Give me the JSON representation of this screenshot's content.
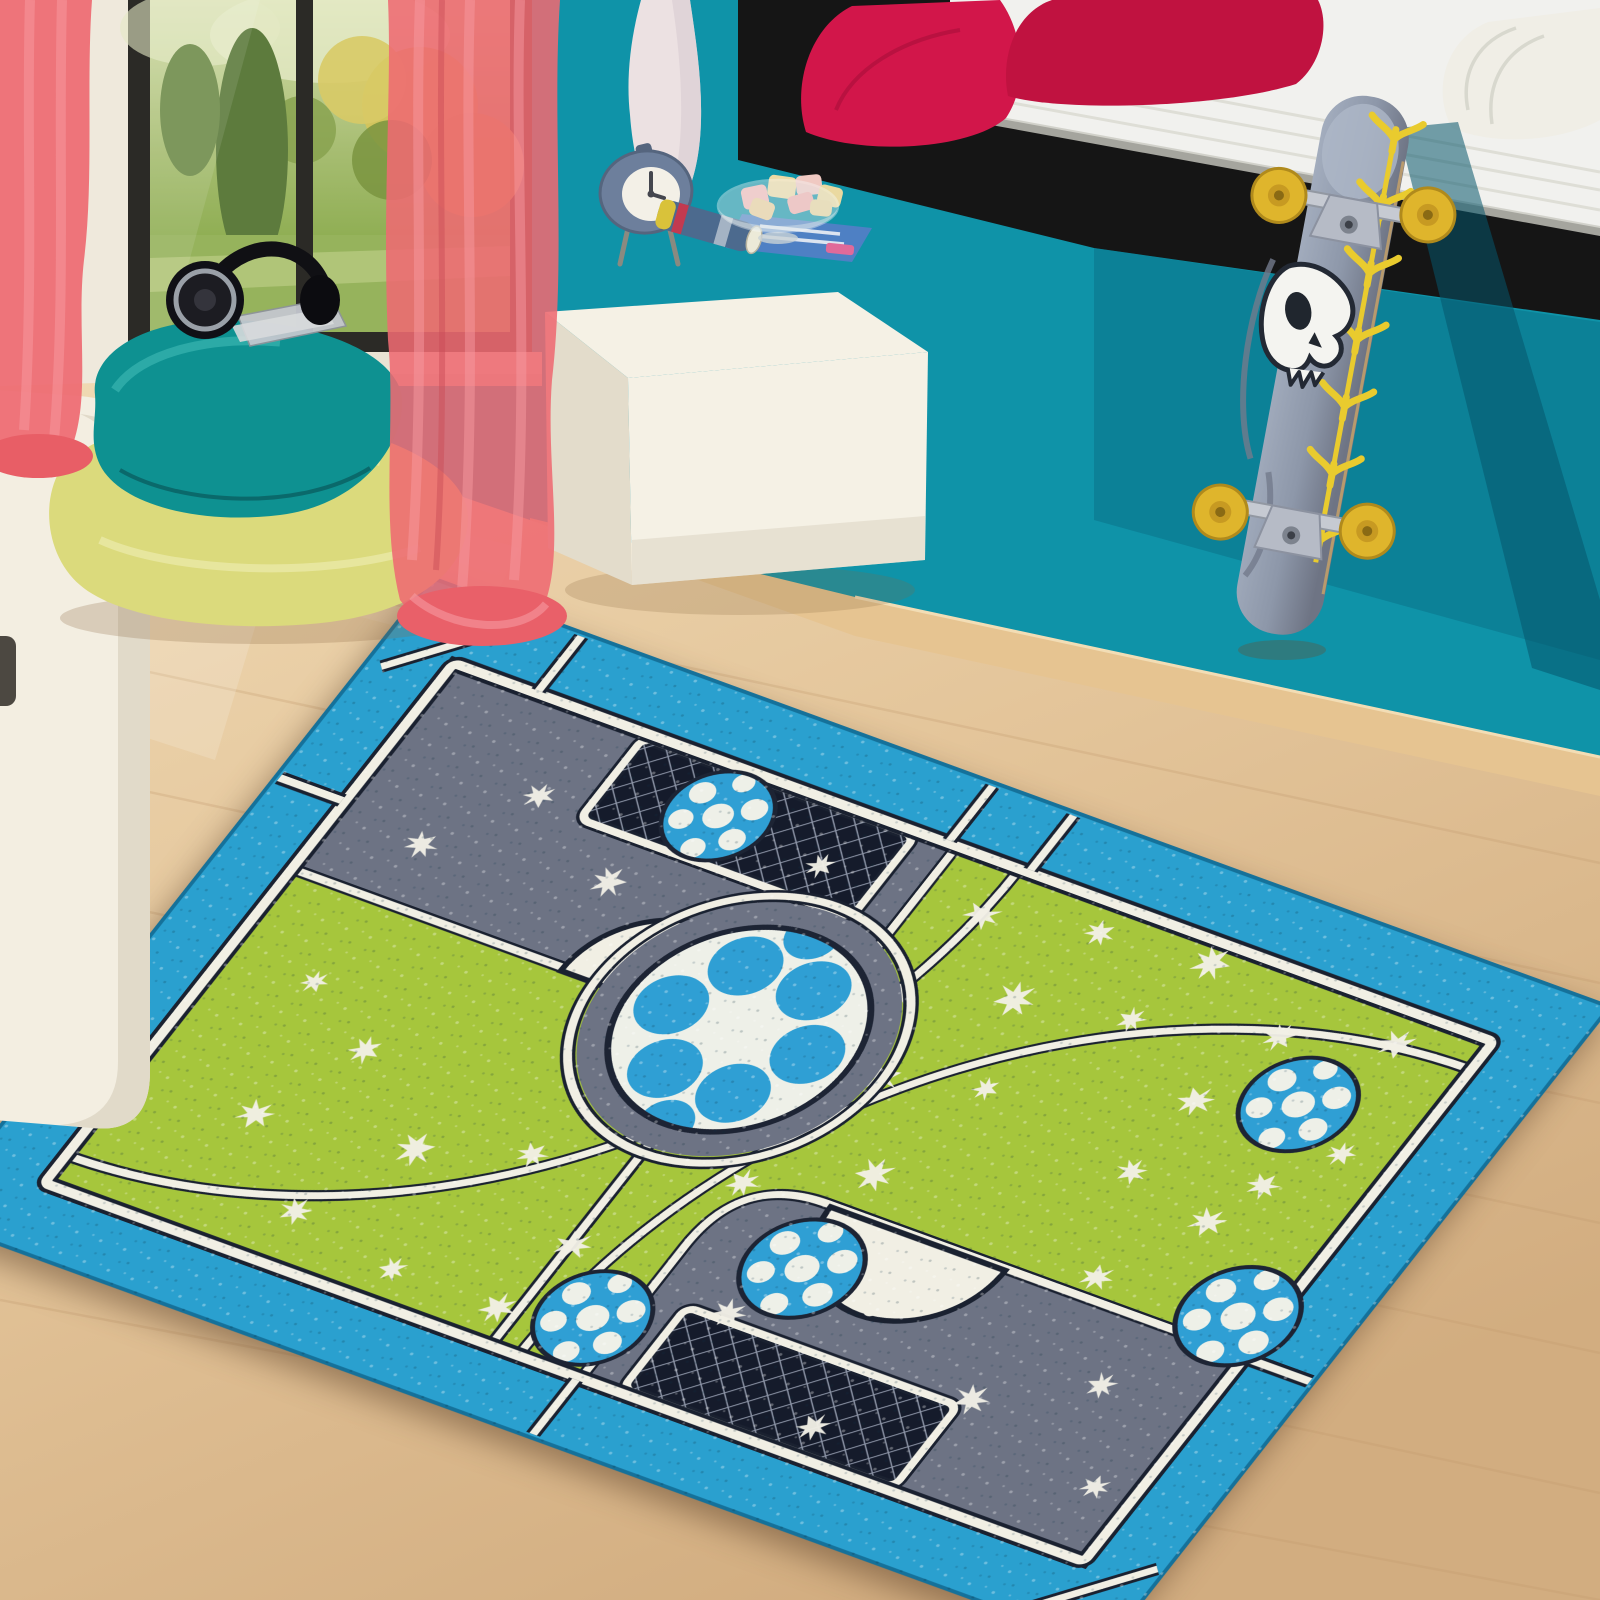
{
  "scene": {
    "description": "Kids bedroom photo: turquoise wall, window to garden with coral curtains, floor cushions with headphones, white cube ottoman with alarm clock and candy bowl, black bed with magenta pillows and white mattress, skull-graphic skateboard leaning on bed, and a large soccer-field play rug on a light wood floor",
    "colors": {
      "wall_teal": "#0f93a8",
      "wall_teal_shadow": "#07667e",
      "baseboard": "#e6c491",
      "curtain_coral": "#ee6a72",
      "window_frame": "#2b2a26",
      "window_pillar": "#efe9dc",
      "garden_green": "#9cb464",
      "garden_yellow": "#d3c45c",
      "pillow_teal": "#0e9191",
      "pillow_yellow": "#dbda7c",
      "bed_base_black": "#151515",
      "mattress_white": "#f1f1ee",
      "bed_pillow_red": "#d2164a",
      "bed_pillow_red_dark": "#c01240",
      "cube_white": "#f5f1e5",
      "clock_blue": "#6d7f9c",
      "vase_white": "#ece1e2",
      "skateboard_deck_gray": "#8d97a9",
      "skateboard_yellow": "#e9cb2e",
      "wheel_yellow": "#dfb52c",
      "rug_border_blue": "#2aa0cf",
      "rug_field_green": "#a6c63c",
      "rug_gray": "#6d7384",
      "rug_goal_navy": "#151b2b",
      "rug_line_cream": "#f1efe4",
      "rug_line_dark": "#1a2130",
      "ball_blue": "#2f9fd4",
      "ball_white": "#eef0e8",
      "floor_wood_light": "#f0dab4",
      "floor_wood_dark": "#d2ad80"
    },
    "objects": {
      "window": {
        "label": "garden window",
        "panes": 2,
        "view": "lawn, cypress tree, yellow flowering shrubs"
      },
      "curtains": {
        "label": "sheer coral curtains",
        "count": 2
      },
      "floor_pillows": {
        "label": "floor cushions",
        "count": 2,
        "top": "teal",
        "bottom": "yellow-green"
      },
      "headphones": {
        "label": "black over-ear headphones on teal cushion"
      },
      "cd_cases": {
        "label": "cd cases beside headphones"
      },
      "side_table": {
        "label": "white rounded side unit, left edge"
      },
      "ottoman": {
        "label": "white leather cube ottoman"
      },
      "alarm_clock": {
        "label": "retro slate-blue alarm clock on legs"
      },
      "candy_bowl": {
        "label": "glass bowl with pink and cream marshmallows"
      },
      "magazine": {
        "label": "rolled magazine and open magazine"
      },
      "vase": {
        "label": "tall white vase"
      },
      "bed": {
        "label": "black platform bed with white mattress"
      },
      "bed_pillows": {
        "label": "magenta pillows and white pillow",
        "count": 3
      },
      "skateboard": {
        "label": "gray skateboard with white skull and yellow arrow chain, yellow wheels"
      },
      "rug": {
        "label": "soccer-field kids play rug",
        "border": "turquoise",
        "field": "green with white grass tufts",
        "penalty_areas": 2,
        "goals_with_net": 2,
        "center_circle_ball": 1,
        "small_soccer_balls": 5
      }
    }
  }
}
